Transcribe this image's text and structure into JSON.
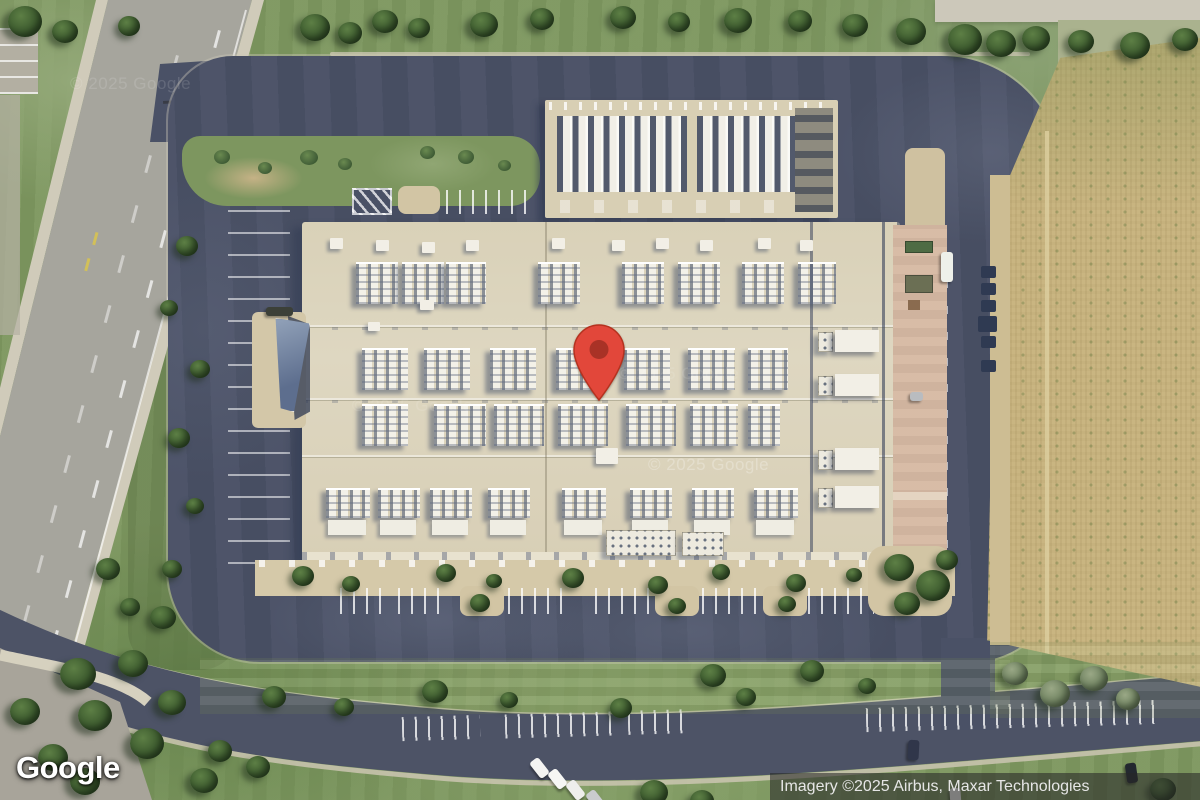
{
  "map": {
    "view": "satellite",
    "logo_text": "Google",
    "attribution_text": "Imagery ©2025 Airbus, Maxar Technologies",
    "watermark_text": "© 2025 Google",
    "marker": {
      "outer": "#E2473A",
      "inner": "#A93226",
      "border": "#B5321F"
    },
    "palette": {
      "asphalt": "#4a5166",
      "roof": "#d9d2bc",
      "walkway": "#d6b9a3",
      "tan": "#d2c5a4",
      "field": "#c9b581",
      "grass": "#7d975f",
      "road_gray": "#a6a59d",
      "sidewalk": "#d0cbba",
      "road_dark": "#4d5366",
      "tree_dark": "#33502a",
      "tree_light": "#5d7f45",
      "white_line": "#ffffff"
    }
  }
}
